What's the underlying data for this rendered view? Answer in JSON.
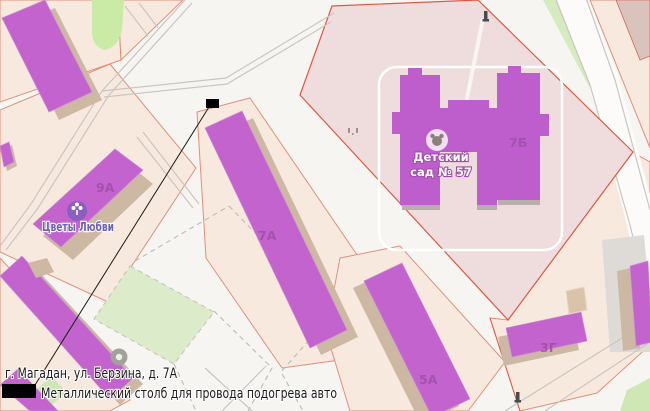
{
  "map": {
    "building_labels": {
      "b9a": "9А",
      "b7a": "7А",
      "b7b": "7Б",
      "b5a": "5А",
      "b3g": "3Г"
    },
    "pois": {
      "flower_shop": {
        "name": "Цветы Любви",
        "icon": "flower-icon",
        "icon_color": "#8a5fc0",
        "label_color": "#6e60ba"
      },
      "kindergarten": {
        "name": "Детский сад № 57",
        "name_line1": "Детский",
        "name_line2": "сад № 57",
        "icon": "kindergarten-icon"
      }
    },
    "colors": {
      "building_fill": "#c263ce",
      "building_shadow": "#cdb8a3",
      "plot_fill": "#f8e9df",
      "plot_border": "#e0907a",
      "territory_fill": "#efdcdc",
      "territory_border": "#dc5a45",
      "green_area": "#c9eba6",
      "sports_field": "#dcecca",
      "road_line": "#c9c6c2",
      "building_label": "#9d50a7"
    }
  },
  "annotation": {
    "address": "г. Магадан, ул. Берзина, д. 7А",
    "note": "Металлический столб для провода подогрева авто",
    "marker_color": "#000000"
  }
}
